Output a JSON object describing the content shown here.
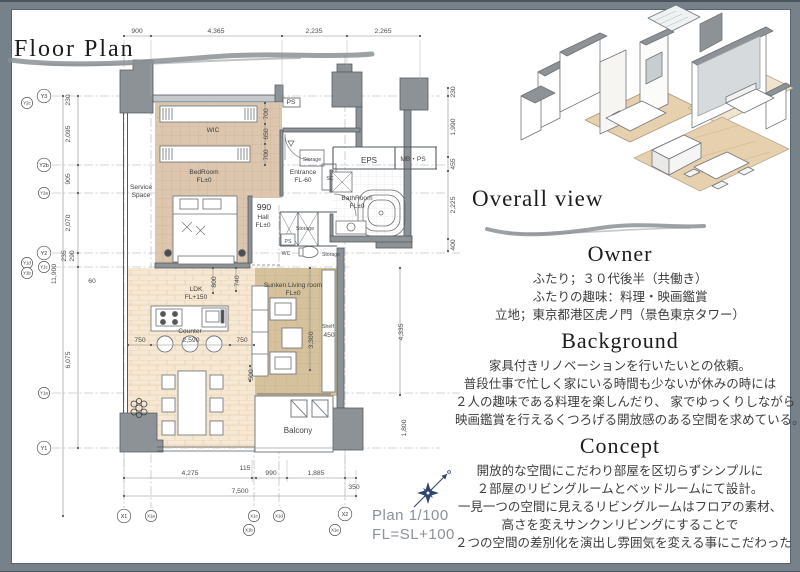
{
  "page": {
    "title": "Floor Plan",
    "overall_view_title": "Overall view",
    "plan_scale_label": "Plan 1/100",
    "fl_label": "FL=SL+100"
  },
  "sections": {
    "owner": {
      "heading": "Owner",
      "lines": [
        "ふたり；３０代後半（共働き）",
        "ふたりの趣味：料理・映画鑑賞",
        "立地；東京都港区虎ノ門（景色東京タワー）"
      ]
    },
    "background": {
      "heading": "Background",
      "lines": [
        "家具付きリノベーションを行いたいとの依頼。",
        "普段仕事で忙しく家にいる時間も少ないが休みの時には",
        "２人の趣味である料理を楽しんだり、 家でゆっくりしながら",
        "映画鑑賞を行えるくつろげる開放感のある空間を求めている。"
      ]
    },
    "concept": {
      "heading": "Concept",
      "lines": [
        "開放的な空間にこだわり部屋を区切らずシンプルに",
        "２部屋のリビングルームとベッドルームにて設計。",
        "一見一つの空間に見えるリビングルームはフロアの素材、",
        "高さを変えサンクンリビングにすることで",
        "２つの空間の差別化を演出し雰囲気を変える事にこだわった"
      ]
    }
  },
  "colors": {
    "frame": "#76818a",
    "page": "#ffffff",
    "wall": "#8d9296",
    "wall_dark": "#565b5f",
    "floor_wic": "#dcc6ae",
    "floor_ldk": "#f6e8d2",
    "floor_sunken": "#d5c29c",
    "dim": "#4c4c4c",
    "grid": "#8f959b",
    "heading": "#1c1c1c",
    "body_text": "#3d3d3d",
    "scale_text": "#8b9298",
    "compass": "#2e4570",
    "brush": "#8b9094",
    "iso_floor": "#e7d0ae"
  },
  "plan": {
    "labels": [
      {
        "t": "900",
        "x": 137,
        "y": 33
      },
      {
        "t": "4,365",
        "x": 216,
        "y": 33
      },
      {
        "t": "2,235",
        "x": 314,
        "y": 33
      },
      {
        "t": "2,265",
        "x": 383,
        "y": 33
      },
      {
        "t": "230",
        "x": 70,
        "y": 100,
        "r": 1
      },
      {
        "t": "2,095",
        "x": 70,
        "y": 134,
        "r": 1
      },
      {
        "t": "905",
        "x": 70,
        "y": 179,
        "r": 1
      },
      {
        "t": "2,070",
        "x": 70,
        "y": 223,
        "r": 1
      },
      {
        "t": "235",
        "x": 66,
        "y": 256,
        "r": 1
      },
      {
        "t": "290",
        "x": 74,
        "y": 256,
        "r": 1
      },
      {
        "t": "11,900",
        "x": 56,
        "y": 274,
        "r": 1
      },
      {
        "t": "60",
        "x": 92,
        "y": 283
      },
      {
        "t": "6,075",
        "x": 70,
        "y": 360,
        "r": 1
      },
      {
        "t": "230",
        "x": 455,
        "y": 92,
        "r": 1
      },
      {
        "t": "1,990",
        "x": 455,
        "y": 127,
        "r": 1
      },
      {
        "t": "455",
        "x": 455,
        "y": 164,
        "r": 1
      },
      {
        "t": "2,225",
        "x": 455,
        "y": 205,
        "r": 1
      },
      {
        "t": "400",
        "x": 455,
        "y": 245,
        "r": 1
      },
      {
        "t": "4,275",
        "x": 190,
        "y": 475
      },
      {
        "t": "115",
        "x": 245,
        "y": 470
      },
      {
        "t": "990",
        "x": 271,
        "y": 475
      },
      {
        "t": "1,885",
        "x": 316,
        "y": 475
      },
      {
        "t": "350",
        "x": 354,
        "y": 489
      },
      {
        "t": "7,500",
        "x": 240,
        "y": 493
      },
      {
        "t": "700",
        "x": 268,
        "y": 114,
        "r": 1
      },
      {
        "t": "650",
        "x": 268,
        "y": 134,
        "r": 1
      },
      {
        "t": "700",
        "x": 268,
        "y": 155,
        "r": 1
      },
      {
        "t": "990",
        "x": 264,
        "y": 210,
        "c": "ph"
      },
      {
        "t": "800",
        "x": 216,
        "y": 282,
        "r": 1
      },
      {
        "t": "740",
        "x": 239,
        "y": 281,
        "r": 1
      },
      {
        "t": "750",
        "x": 140,
        "y": 342
      },
      {
        "t": "2,590",
        "x": 191,
        "y": 342
      },
      {
        "t": "750",
        "x": 242,
        "y": 342
      },
      {
        "t": "500",
        "x": 253,
        "y": 375,
        "r": 1
      },
      {
        "t": "3,300",
        "x": 313,
        "y": 340,
        "r": 1
      },
      {
        "t": "4,335",
        "x": 403,
        "y": 332,
        "r": 1
      },
      {
        "t": "1,800",
        "x": 406,
        "y": 428,
        "r": 1
      },
      {
        "t": "Shelf",
        "x": 328,
        "y": 328,
        "c": "pt"
      },
      {
        "t": "450",
        "x": 329,
        "y": 337
      },
      {
        "t": "WIC",
        "x": 213,
        "y": 132,
        "c": "pr"
      },
      {
        "t": "BedRoom",
        "x": 204,
        "y": 174,
        "c": "pr"
      },
      {
        "t": "FL±0",
        "x": 204,
        "y": 182,
        "c": "pr"
      },
      {
        "t": "Service",
        "x": 141,
        "y": 189,
        "c": "pr"
      },
      {
        "t": "Space",
        "x": 141,
        "y": 197,
        "c": "pr"
      },
      {
        "t": "Entrance",
        "x": 303,
        "y": 174,
        "c": "pr"
      },
      {
        "t": "FL-60",
        "x": 303,
        "y": 182,
        "c": "pr"
      },
      {
        "t": "SC",
        "x": 330,
        "y": 180,
        "c": "pt"
      },
      {
        "t": "Storage",
        "x": 312,
        "y": 161,
        "c": "pt"
      },
      {
        "t": "EPS",
        "x": 369,
        "y": 163,
        "c": "pb"
      },
      {
        "t": "MB・PS",
        "x": 413,
        "y": 161,
        "c": "pr"
      },
      {
        "t": "BathRoom",
        "x": 357,
        "y": 200,
        "c": "pr"
      },
      {
        "t": "FL±0",
        "x": 357,
        "y": 208,
        "c": "pr"
      },
      {
        "t": "Hall",
        "x": 263,
        "y": 219,
        "c": "pr"
      },
      {
        "t": "FL±0",
        "x": 263,
        "y": 227,
        "c": "pr"
      },
      {
        "t": "Storage",
        "x": 305,
        "y": 230,
        "c": "pt"
      },
      {
        "t": "PS",
        "x": 288,
        "y": 243,
        "c": "pt"
      },
      {
        "t": "WC",
        "x": 286,
        "y": 255,
        "c": "pt"
      },
      {
        "t": "Storage",
        "x": 331,
        "y": 256,
        "c": "pt"
      },
      {
        "t": "PS",
        "x": 291,
        "y": 104,
        "c": "pr"
      },
      {
        "t": "LDK",
        "x": 196,
        "y": 291,
        "c": "pr"
      },
      {
        "t": "FL+150",
        "x": 196,
        "y": 299,
        "c": "pr"
      },
      {
        "t": "Counter",
        "x": 190,
        "y": 333,
        "c": "pr"
      },
      {
        "t": "Sunken Living room",
        "x": 293,
        "y": 287,
        "c": "pr"
      },
      {
        "t": "FL±0",
        "x": 293,
        "y": 295,
        "c": "pr"
      },
      {
        "t": "Balcony",
        "x": 298,
        "y": 433,
        "c": "pb"
      }
    ],
    "grid_bubbles": [
      {
        "t": "Y3",
        "x": 44,
        "y": 96
      },
      {
        "t": "Y2c",
        "x": 27,
        "y": 103,
        "s": 1
      },
      {
        "t": "Y2b",
        "x": 44,
        "y": 165
      },
      {
        "t": "Y2a",
        "x": 44,
        "y": 193,
        "s": 1
      },
      {
        "t": "Y2",
        "x": 44,
        "y": 253
      },
      {
        "t": "Y1d",
        "x": 27,
        "y": 263,
        "s": 1
      },
      {
        "t": "Y1c",
        "x": 44,
        "y": 267,
        "s": 1
      },
      {
        "t": "Y1b",
        "x": 27,
        "y": 273,
        "s": 1
      },
      {
        "t": "Y1a",
        "x": 44,
        "y": 393,
        "s": 1
      },
      {
        "t": "Y1",
        "x": 44,
        "y": 448
      },
      {
        "t": "X1",
        "x": 124,
        "y": 516
      },
      {
        "t": "X1a",
        "x": 151,
        "y": 516,
        "s": 1
      },
      {
        "t": "X1c",
        "x": 254,
        "y": 516,
        "s": 1
      },
      {
        "t": "X1b",
        "x": 249,
        "y": 530,
        "s": 1
      },
      {
        "t": "X1d",
        "x": 279,
        "y": 516,
        "s": 1
      },
      {
        "t": "X2",
        "x": 345,
        "y": 514
      },
      {
        "t": "X1e",
        "x": 335,
        "y": 530,
        "s": 1
      }
    ],
    "dim_ticks": [
      [
        124,
        36
      ],
      [
        151,
        36
      ],
      [
        282,
        36
      ],
      [
        347,
        36
      ],
      [
        420,
        36
      ],
      [
        124,
        478
      ],
      [
        252,
        478
      ],
      [
        256,
        478
      ],
      [
        287,
        478
      ],
      [
        345,
        478
      ],
      [
        356,
        478
      ],
      [
        124,
        496
      ],
      [
        356,
        496
      ],
      [
        78,
        96
      ],
      [
        78,
        165
      ],
      [
        78,
        193
      ],
      [
        78,
        253
      ],
      [
        78,
        267
      ],
      [
        78,
        448
      ],
      [
        63,
        96
      ],
      [
        63,
        516
      ],
      [
        448,
        88
      ],
      [
        448,
        96
      ],
      [
        448,
        157
      ],
      [
        448,
        171
      ],
      [
        448,
        239
      ],
      [
        448,
        251
      ],
      [
        128,
        345
      ],
      [
        151,
        345
      ],
      [
        230,
        345
      ],
      [
        254,
        345
      ],
      [
        265,
        103
      ],
      [
        265,
        124
      ],
      [
        265,
        144
      ],
      [
        265,
        165
      ],
      [
        310,
        268
      ],
      [
        310,
        370
      ],
      [
        400,
        268
      ],
      [
        400,
        395
      ],
      [
        213,
        268
      ],
      [
        213,
        293
      ],
      [
        236,
        268
      ],
      [
        236,
        291
      ],
      [
        250,
        366
      ],
      [
        250,
        381
      ]
    ]
  }
}
